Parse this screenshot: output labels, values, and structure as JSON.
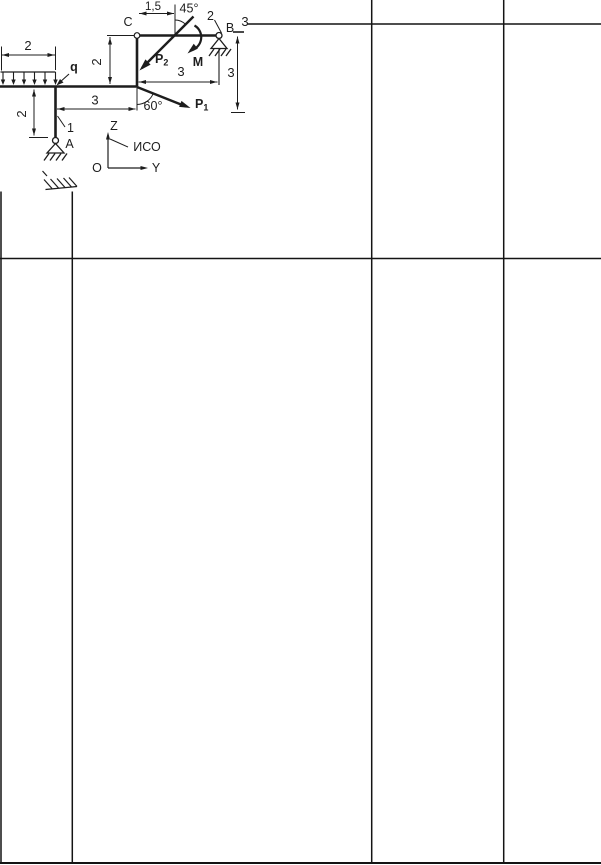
{
  "colors": {
    "ink": "#1d1d1d",
    "grid": "#141414",
    "paper": "#ffffff"
  },
  "diagram": {
    "variant": "3",
    "points": {
      "a": "A",
      "b": "B",
      "c": "C"
    },
    "members": {
      "m1": "1",
      "m2": "2"
    },
    "load": {
      "q": "q"
    },
    "forces": {
      "p1_main": "P",
      "p1_sub": "1",
      "p2_main": "P",
      "p2_sub": "2",
      "moment": "M"
    },
    "angles": {
      "a45": "45°",
      "a60": "60°"
    },
    "dims": {
      "load_width": "2",
      "col_a_height": "2",
      "span_a_c": "3",
      "col_c_height": "2",
      "offset_c_p2": "1,5",
      "span_c_b": "3",
      "height_b": "3"
    },
    "axes": {
      "z": "Z",
      "y": "Y",
      "origin": "O",
      "note": "ИСО"
    }
  }
}
